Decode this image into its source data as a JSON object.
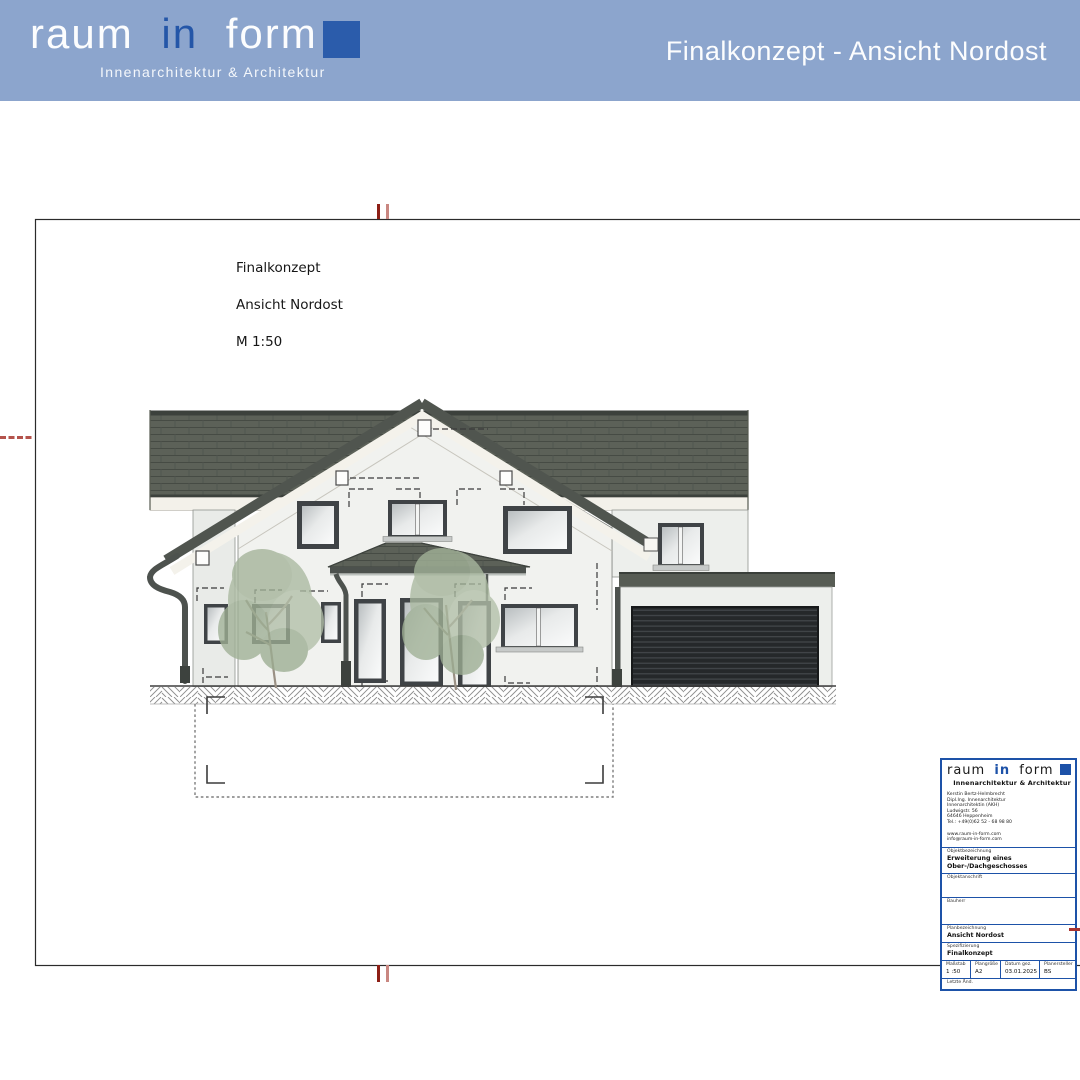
{
  "header": {
    "title": "Finalkonzept - Ansicht Nordost"
  },
  "logo": {
    "word1": "raum",
    "word2": "in",
    "word3": "form",
    "tagline": "Innenarchitektur & Architektur"
  },
  "drawing_label": {
    "line1": "Finalkonzept",
    "line2": "Ansicht Nordost",
    "line3": "M 1:50"
  },
  "title_block": {
    "address_lines": {
      "0": "Kerstin Bertz-Helmbrecht",
      "1": "Dipl.Ing. Innenarchitektur",
      "2": "Innenarchitektin (AKH)",
      "3": "Ludwigstr. 56",
      "4": "64646 Heppenheim",
      "5": "Tel.: +49(0)62 52 - 68 98 80"
    },
    "contact_lines": {
      "0": "www.raum-in-form.com",
      "1": "info@raum-in-form.com"
    },
    "fields": {
      "0": {
        "label": "Objektbezeichnung",
        "value": "Erweiterung eines Ober-/Dachgeschosses"
      },
      "1": {
        "label": "Objektanschrift",
        "value": ""
      },
      "2": {
        "label": "Bauherr",
        "value": ""
      },
      "3": {
        "label": "Planbezeichnung",
        "value": "Ansicht Nordost"
      },
      "4": {
        "label": "Spezifizierung",
        "value": "Finalkonzept"
      }
    },
    "meta": {
      "0": {
        "label": "Maßstab",
        "value": "1 :50"
      },
      "1": {
        "label": "Plangröße",
        "value": "A2"
      },
      "2": {
        "label": "Datum gez.",
        "value": "03.01.2025"
      },
      "3": {
        "label": "Planersteller",
        "value": "BS"
      }
    },
    "footer_label": "Letzte Änd."
  },
  "colors": {
    "header_blue": "#8ca5cd",
    "brand_blue": "#1d52a8",
    "roof_gray": "#5c6158",
    "wall_gray": "#f1f2ef",
    "garage_door": "#25282a",
    "tree_green": "#aab9a0",
    "mark_red": "#a83430"
  }
}
